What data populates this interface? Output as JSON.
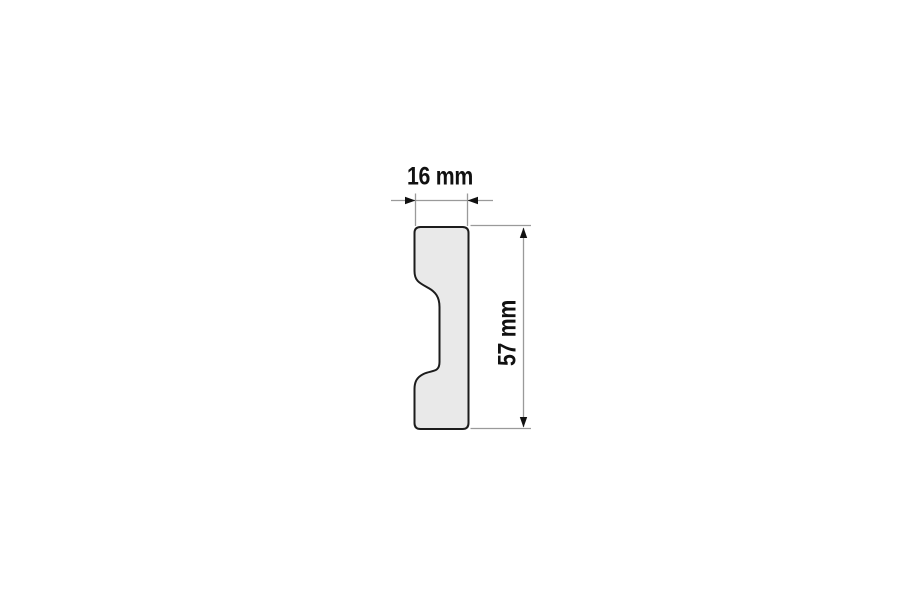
{
  "drawing": {
    "type": "technical-cross-section",
    "subject": "moulding-profile",
    "width_dimension": {
      "label": "16 mm",
      "value_mm": 16
    },
    "height_dimension": {
      "label": "57 mm",
      "value_mm": 57
    },
    "colors": {
      "background": "#ffffff",
      "profile_fill": "#e9e9e9",
      "profile_outline": "#1c1c1c",
      "dimension_lines": "#9a9a9a",
      "arrows_and_text": "#111111"
    }
  }
}
